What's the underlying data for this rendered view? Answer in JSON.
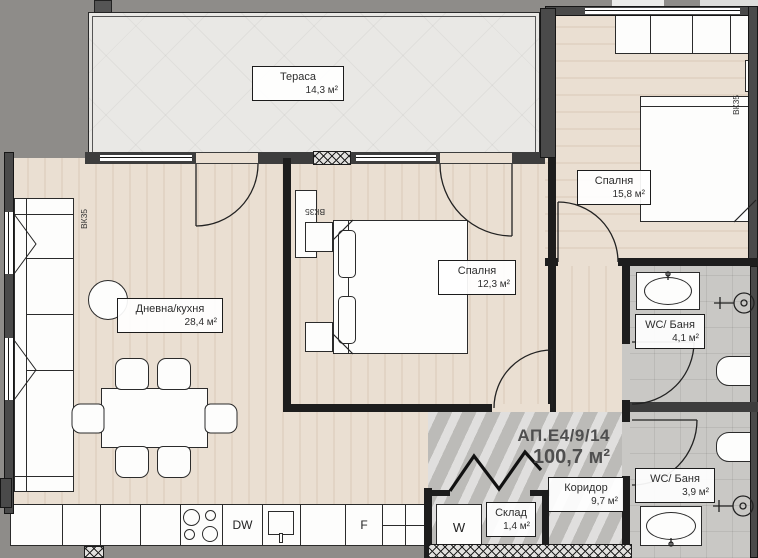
{
  "plan": {
    "unit_title": "АП.Е4/9/14",
    "unit_area": "100,7 м²",
    "rooms": {
      "terrace": {
        "name": "Тераса",
        "area": "14,3 м²"
      },
      "bedroom_large": {
        "name": "Спалня",
        "area": "15,8 м²"
      },
      "bedroom_small": {
        "name": "Спалня",
        "area": "12,3 м²"
      },
      "living_kitchen": {
        "name": "Дневна/кухня",
        "area": "28,4 м²"
      },
      "bath_top": {
        "name": "WC/ Баня",
        "area": "4,1 м²"
      },
      "bath_bottom": {
        "name": "WC/ Баня",
        "area": "3,9 м²"
      },
      "corridor": {
        "name": "Коридор",
        "area": "9,7 м²"
      },
      "storage": {
        "name": "Склад",
        "area": "1,4 м²"
      }
    },
    "appliances": {
      "dishwasher": "DW",
      "fridge": "F",
      "washer": "W"
    },
    "shafts": {
      "left": "ВК35",
      "middle": "ВК35",
      "right": "ВК35"
    },
    "colors": {
      "background": "#8e8c89",
      "wall": "#1d1d1d",
      "exterior_wall": "#4a4a4a",
      "wood_floor": "#eadfd2",
      "tile_floor": "#c9c8c5",
      "terrace_floor": "#e9e8e5",
      "partition_accent": "#5a6570"
    }
  }
}
